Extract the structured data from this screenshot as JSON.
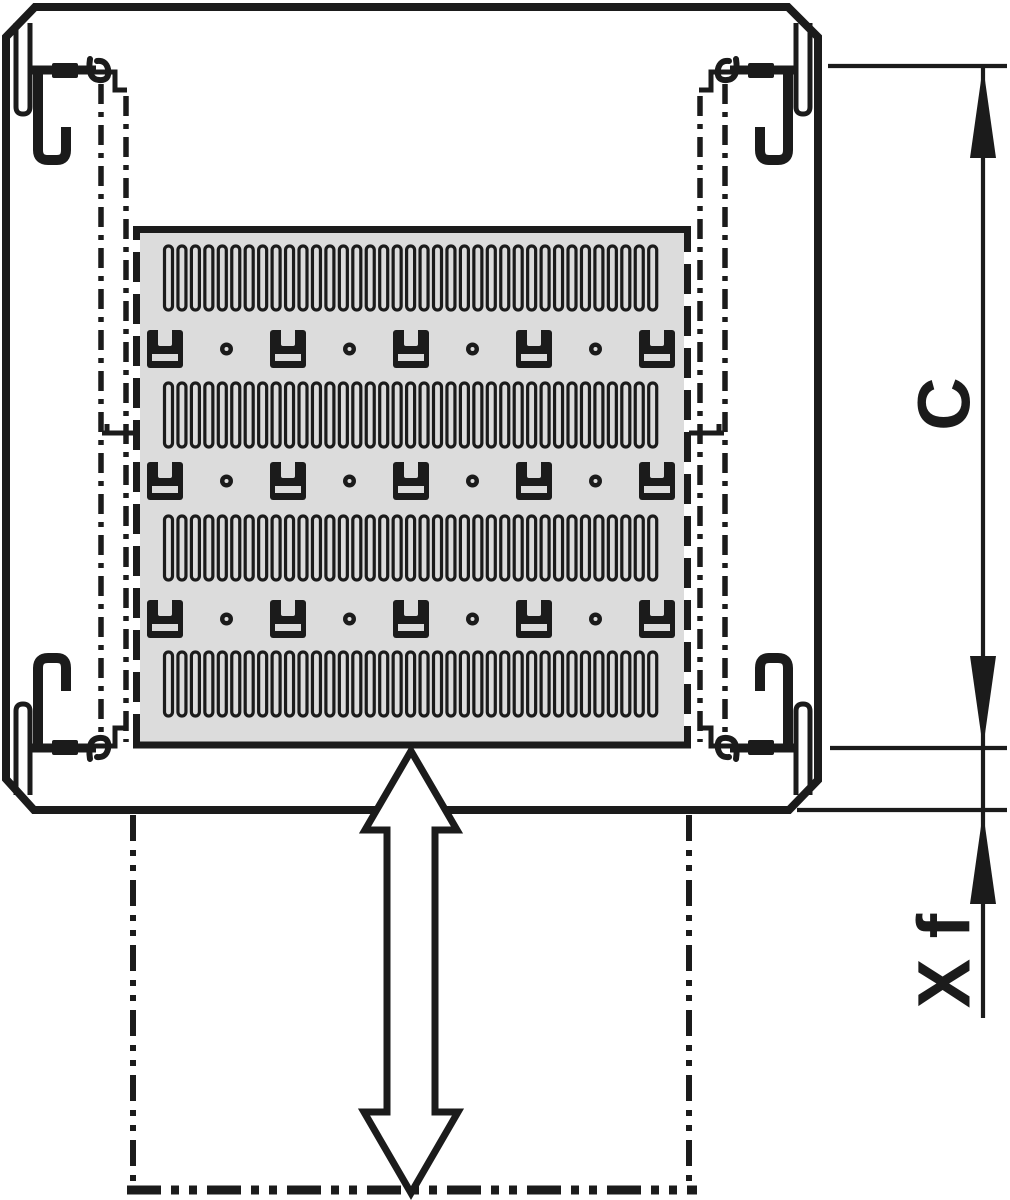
{
  "drawing_title": "rack-shelf-slide-diagram",
  "dimensions": {
    "c": {
      "label": "C"
    },
    "xf": {
      "label": "X f"
    }
  },
  "colors": {
    "line": "#1b1b1b",
    "panel_fill": "#dcdcdc",
    "background": "#ffffff"
  },
  "panel": {
    "slot_rows": {
      "row_y": [
        246,
        383,
        516,
        652
      ],
      "count_per_row": 37,
      "first_center_x": 168.5,
      "pitch_x": 13.45,
      "slot_width": 8,
      "slot_height": 64
    },
    "bracket_rows": {
      "row_y": [
        330,
        462,
        600
      ],
      "bracket_centers_x": [
        165,
        288,
        411,
        534,
        657
      ],
      "dot_centers_x": [
        226.5,
        349.5,
        472.5,
        595.5
      ],
      "bracket_width": 36,
      "bracket_height": 38,
      "dot_radius": 6.5
    }
  }
}
